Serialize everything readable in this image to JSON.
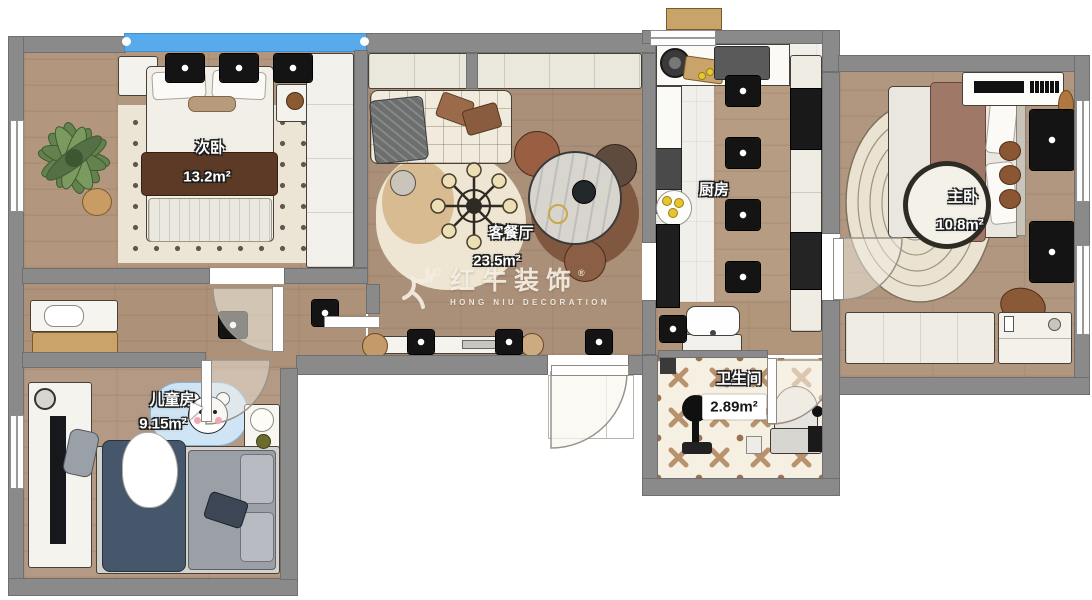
{
  "plan": {
    "watermark": {
      "brand": "红牛装饰",
      "subtitle": "HONG NIU DECORATION",
      "registered": "®"
    },
    "rooms": [
      {
        "key": "secondary-bedroom",
        "name": "次卧",
        "area": "13.2m²"
      },
      {
        "key": "living-dining",
        "name": "客餐厅",
        "area": "23.5m²"
      },
      {
        "key": "kitchen",
        "name": "厨房",
        "area": ""
      },
      {
        "key": "master-bedroom",
        "name": "主卧",
        "area": "10.8m²"
      },
      {
        "key": "kids-room",
        "name": "儿童房",
        "area": "9.15m²"
      },
      {
        "key": "bathroom",
        "name": "卫生间",
        "area": "2.89m²"
      }
    ],
    "colors": {
      "wall": "#8a8a8a",
      "window_glass": "#57abec",
      "wood_floor": "#b2977e",
      "bath_tile": "#f6f0e3",
      "fixture_black": "#161616"
    }
  }
}
